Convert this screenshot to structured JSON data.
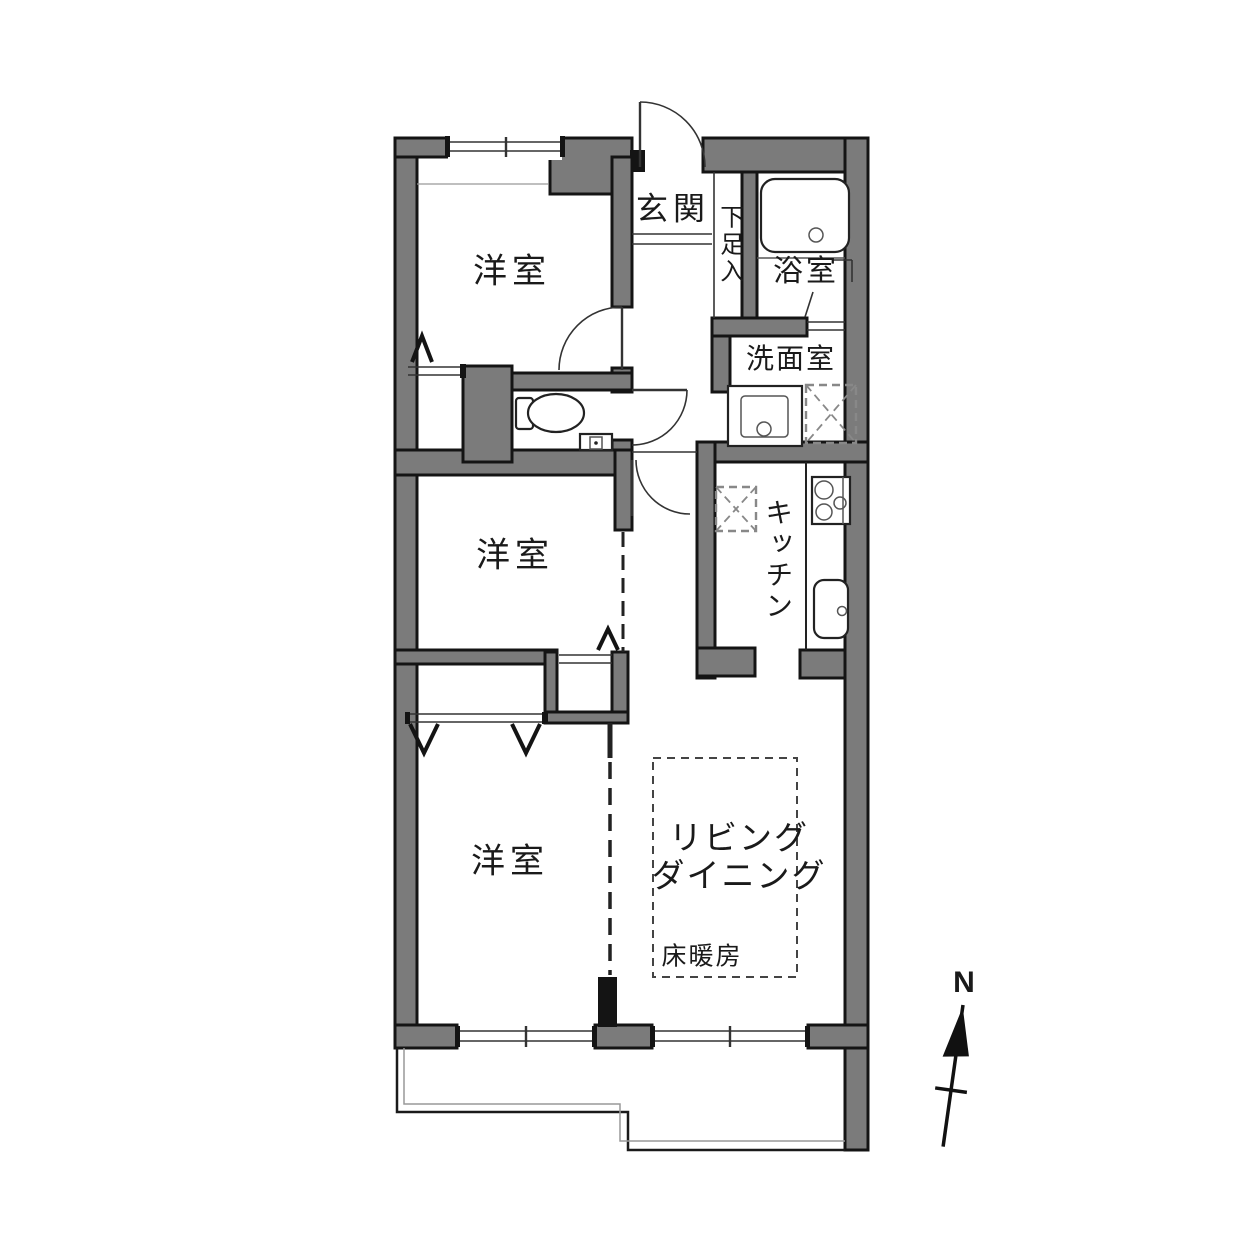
{
  "floorplan": {
    "rooms": {
      "western_room_1": "洋室",
      "western_room_2": "洋室",
      "western_room_3": "洋室",
      "entrance": "玄関",
      "shoe_cabinet": "下足入",
      "bathroom": "浴室",
      "washroom": "洗面室",
      "kitchen": "キッチン",
      "living": "リビング",
      "dining": "ダイニング",
      "floor_heating": "床暖房"
    },
    "compass": {
      "north_label": "N"
    },
    "colors": {
      "wall_fill": "#7b7b7b",
      "wall_stroke": "#141414",
      "line": "#333333",
      "background": "#ffffff"
    }
  }
}
